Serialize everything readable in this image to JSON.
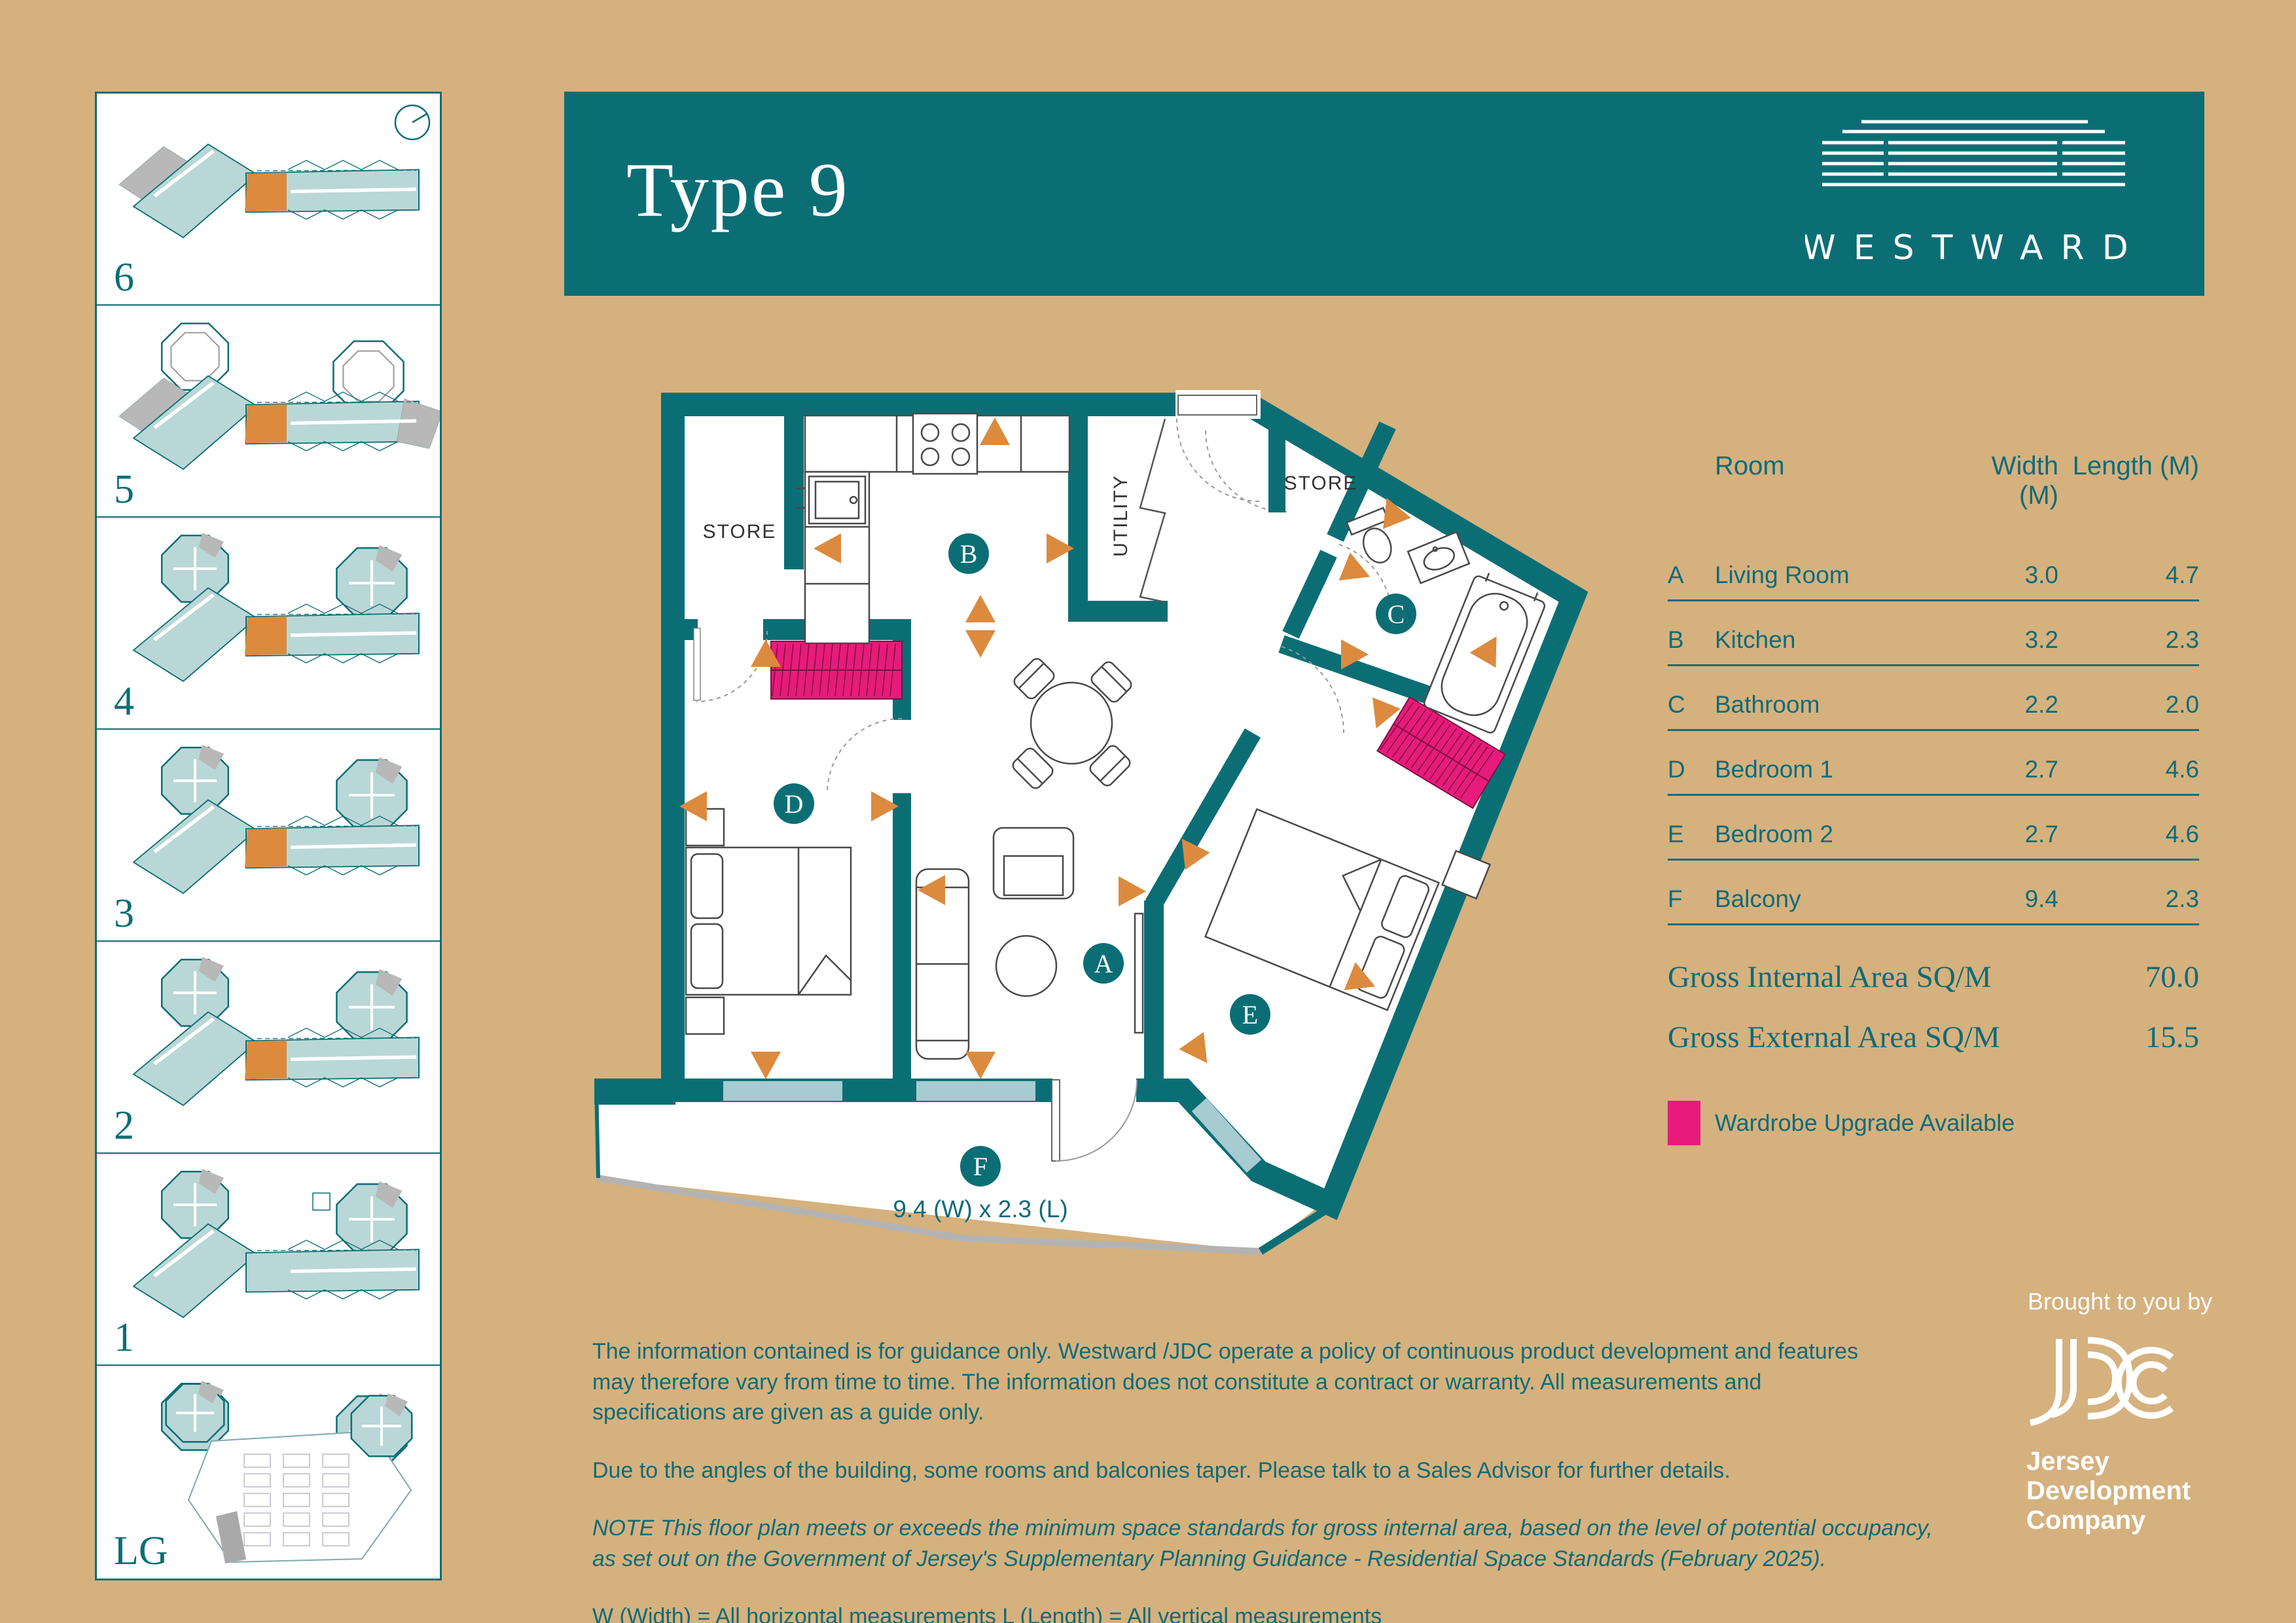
{
  "header": {
    "title": "Type 9",
    "brand": "WESTWARD"
  },
  "sidebar": {
    "floors": [
      {
        "label": "6"
      },
      {
        "label": "5"
      },
      {
        "label": "4"
      },
      {
        "label": "3"
      },
      {
        "label": "2"
      },
      {
        "label": "1"
      },
      {
        "label": "LG"
      }
    ]
  },
  "plan": {
    "rooms": {
      "store1": "STORE",
      "utility": "UTILITY",
      "store2": "STORE"
    },
    "labels": {
      "a": "A",
      "b": "B",
      "c": "C",
      "d": "D",
      "e": "E",
      "f": "F"
    },
    "balcony_dim": "9.4 (W) x 2.3 (L)"
  },
  "table": {
    "headers": {
      "room": "Room",
      "width": "Width (M)",
      "length": "Length (M)"
    },
    "rows": [
      {
        "key": "A",
        "name": "Living Room",
        "width": "3.0",
        "length": "4.7"
      },
      {
        "key": "B",
        "name": "Kitchen",
        "width": "3.2",
        "length": "2.3"
      },
      {
        "key": "C",
        "name": "Bathroom",
        "width": "2.2",
        "length": "2.0"
      },
      {
        "key": "D",
        "name": "Bedroom 1",
        "width": "2.7",
        "length": "4.6"
      },
      {
        "key": "E",
        "name": "Bedroom 2",
        "width": "2.7",
        "length": "4.6"
      },
      {
        "key": "F",
        "name": "Balcony",
        "width": "9.4",
        "length": "2.3"
      }
    ],
    "gross_internal_label": "Gross Internal Area SQ/M",
    "gross_internal_value": "70.0",
    "gross_external_label": "Gross External Area SQ/M",
    "gross_external_value": "15.5",
    "legend": "Wardrobe Upgrade Available"
  },
  "footer": {
    "para1": "The information contained is for guidance only. Westward /JDC operate a policy of continuous product development and features may therefore vary from time to time. The information does not constitute a contract or warranty. All measurements and specifications are given as a guide only.",
    "para2": "Due to the angles of the building, some rooms and balconies taper. Please talk to a Sales Advisor for further details.",
    "para3": "NOTE This floor plan meets or exceeds the minimum space standards for gross internal area, based on the level of potential occupancy, as set out on the Government of Jersey's Supplementary Planning Guidance - Residential Space Standards (February 2025).",
    "para4": "W (Width) = All horizontal measurements  L (Length) = All vertical measurements"
  },
  "jdc": {
    "tagline": "Brought to you by",
    "name_line1": "Jersey",
    "name_line2": "Development",
    "name_line3": "Company"
  },
  "colors": {
    "teal": "#0c6e75",
    "tan": "#d5b17e",
    "orange": "#dc8a3e",
    "pink": "#e71b7b",
    "glazing": "#a6cbd0",
    "thumb_fill": "#b9d7d6",
    "slab_gray": "#b3b3b3"
  }
}
